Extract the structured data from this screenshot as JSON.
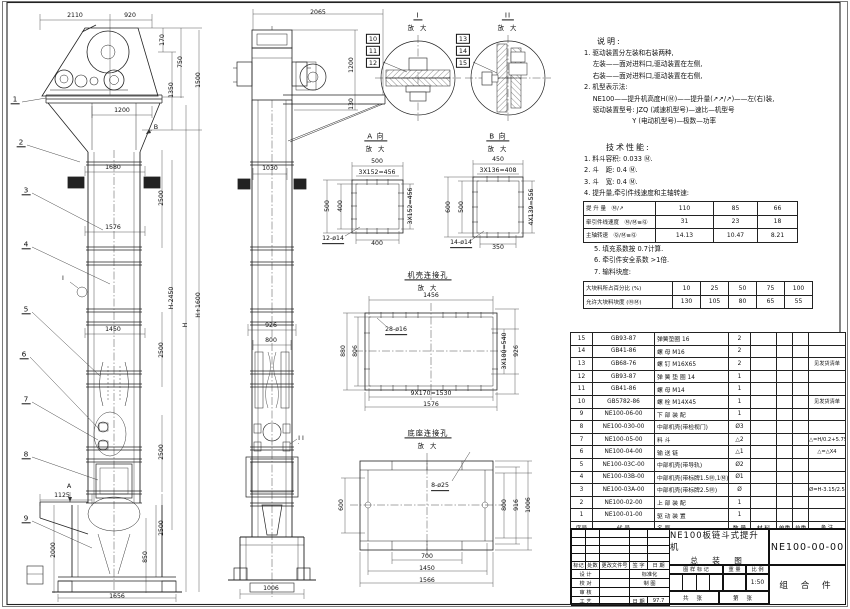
{
  "views": {
    "front": {
      "dims": [
        "2110",
        "920",
        "170",
        "750",
        "1350",
        "1500",
        "1200",
        "1680",
        "2500",
        "1576",
        "H+1600",
        "H-2450",
        "H",
        "1450",
        "2500",
        "2500",
        "2500",
        "1125",
        "2000",
        "850",
        "1656"
      ],
      "leaders": [
        "1",
        "2",
        "3",
        "4",
        "5",
        "6",
        "7",
        "8",
        "9"
      ],
      "section_a": "A",
      "section_b": "B",
      "detail_ref": "I"
    },
    "side": {
      "dims": [
        "2065",
        "1200",
        "130",
        "1030",
        "926",
        "800",
        "1006"
      ],
      "stack_i": [
        "10",
        "11",
        "12"
      ],
      "stack_ii": [
        "13",
        "14",
        "15"
      ],
      "detail_ref": "II"
    },
    "detail_i": {
      "title": "I",
      "zoom": "放 大"
    },
    "detail_ii": {
      "title": "II",
      "zoom": "放 大"
    },
    "view_a": {
      "title": "A 向",
      "zoom": "放 大",
      "dims": [
        "500",
        "3X152=456",
        "500",
        "400",
        "3X152=456",
        "400"
      ],
      "holes": "12-ø14"
    },
    "view_b": {
      "title": "B 向",
      "zoom": "放 大",
      "dims": [
        "450",
        "3X136=408",
        "600",
        "500",
        "4X139=556",
        "350"
      ],
      "holes": "14-ø14"
    },
    "casing": {
      "title": "机壳连接孔",
      "zoom": "放 大",
      "dims": [
        "1456",
        "880",
        "806",
        "3X180=540",
        "926",
        "9X170=1530",
        "1576"
      ],
      "holes": "28-ø16"
    },
    "base": {
      "title": "底座连接孔",
      "zoom": "放 大",
      "dims": [
        "600",
        "800",
        "916",
        "1006",
        "700",
        "1450",
        "1566"
      ],
      "holes": "8-ø25"
    }
  },
  "notes": {
    "title": "说明:",
    "lines": [
      "1. 驱动装置分左装和右装两种,",
      "　 左装——面对进料口,驱动装置在左侧,",
      "　 右装——面对进料口,驱动装置在右侧,",
      "2. 机型表示法:",
      "　 NE100——提升机高度H(Ⓜ)——提升量(↗↗/↗)——左(右)装,",
      "　 驱动装置型号: JZQ (减速机型号)—速比—机型号",
      "　　　　　　　 Y (电动机型号)—极数—功率"
    ]
  },
  "tech": {
    "title": "技术性能:",
    "lines": [
      "1. 料斗容积: 0.033 Ⓜ.",
      "2. 斗　距: 0.4 Ⓜ.",
      "3. 斗　宽: 0.4 Ⓜ.",
      "4. 提升量,牵引件线速度和主轴转速:"
    ],
    "lines2": [
      "5. 填充系数按 0.7计算.",
      "6. 牵引件安全系数 >1倍.",
      "7. 输料块度:"
    ]
  },
  "speed_table": {
    "rows": [
      {
        "label": "提 升 量　Ⓜ/↗",
        "v1": "110",
        "v2": "85",
        "v3": "66"
      },
      {
        "label": "牵引件线速度　Ⓜ/Ⓜ≡Ⓠ",
        "v1": "31",
        "v2": "23",
        "v3": "18"
      },
      {
        "label": "主轴转速　Ⓠ/Ⓜ≡Ⓠ",
        "v1": "14.13",
        "v2": "10.47",
        "v3": "8.21"
      }
    ]
  },
  "lump_table": {
    "rows": [
      {
        "label": "大块料所占百分比 (%)",
        "v1": "10",
        "v2": "25",
        "v3": "50",
        "v4": "75",
        "v5": "100"
      },
      {
        "label": "允许大块料块度 (ⓂⓂ)",
        "v1": "130",
        "v2": "105",
        "v3": "80",
        "v4": "65",
        "v5": "55"
      }
    ]
  },
  "parts_list": {
    "headers": [
      "序号",
      "代  号",
      "名  称",
      "数 量",
      "材  料",
      "单重",
      "总重",
      "备 注"
    ],
    "rows": [
      {
        "no": "15",
        "code": "GB93-87",
        "name": "弹簧垫圈 16",
        "qty": "2",
        "mat": "",
        "uw": "",
        "tw": "",
        "rem": ""
      },
      {
        "no": "14",
        "code": "GB41-86",
        "name": "螺  母 M16",
        "qty": "2",
        "mat": "",
        "uw": "",
        "tw": "",
        "rem": ""
      },
      {
        "no": "13",
        "code": "GB68-76",
        "name": "螺  钉 M16X65",
        "qty": "2",
        "mat": "",
        "uw": "",
        "tw": "",
        "rem": "见发货清单"
      },
      {
        "no": "12",
        "code": "GB93-87",
        "name": "弹 簧 垫 圈 14",
        "qty": "1",
        "mat": "",
        "uw": "",
        "tw": "",
        "rem": ""
      },
      {
        "no": "11",
        "code": "GB41-86",
        "name": "螺  母 M14",
        "qty": "1",
        "mat": "",
        "uw": "",
        "tw": "",
        "rem": ""
      },
      {
        "no": "10",
        "code": "GB5782-86",
        "name": "螺  栓 M14X45",
        "qty": "1",
        "mat": "",
        "uw": "",
        "tw": "",
        "rem": "见发货清单"
      },
      {
        "no": "9",
        "code": "NE100-06-00",
        "name": "下 部 装 配",
        "qty": "1",
        "mat": "",
        "uw": "",
        "tw": "",
        "rem": ""
      },
      {
        "no": "8",
        "code": "NE100-030-00",
        "name": "中部机壳(带检视门)",
        "qty": "Ø3",
        "mat": "",
        "uw": "",
        "tw": "",
        "rem": ""
      },
      {
        "no": "7",
        "code": "NE100-05-00",
        "name": "料  斗",
        "qty": "△2",
        "mat": "",
        "uw": "",
        "tw": "",
        "rem": "△=H/0.2+5.75"
      },
      {
        "no": "6",
        "code": "NE100-04-00",
        "name": "输 送 链",
        "qty": "△1",
        "mat": "",
        "uw": "",
        "tw": "",
        "rem": "△=△X4"
      },
      {
        "no": "5",
        "code": "NE100-03C-00",
        "name": "中部机壳(带导轨)",
        "qty": "Ø2",
        "mat": "",
        "uw": "",
        "tw": "",
        "rem": ""
      },
      {
        "no": "4",
        "code": "NE100-03B-00",
        "name": "中部机壳(带标牌1.5Ⓜ,1Ⓜ)",
        "qty": "Ø1",
        "mat": "",
        "uw": "",
        "tw": "",
        "rem": ""
      },
      {
        "no": "3",
        "code": "NE100-03A-00",
        "name": "中部机壳(带标牌2.5Ⓜ)",
        "qty": "Ø",
        "mat": "",
        "uw": "",
        "tw": "",
        "rem": "Ø=H-3.15/2.5"
      },
      {
        "no": "2",
        "code": "NE100-02-00",
        "name": "上 部 装 配",
        "qty": "1",
        "mat": "",
        "uw": "",
        "tw": "",
        "rem": ""
      },
      {
        "no": "1",
        "code": "NE100-01-00",
        "name": "驱 动 装 置",
        "qty": "1",
        "mat": "",
        "uw": "",
        "tw": "",
        "rem": ""
      }
    ]
  },
  "title_block": {
    "product": "NE100板链斗式提升机",
    "sheet_name": "总 装 图",
    "drawing_no": "NE100-00-00",
    "part_type": "组 合 件",
    "rev_headers": [
      "标记",
      "处数",
      "更改文件号",
      "签 字",
      "日 期"
    ],
    "roles": [
      {
        "l": "设 计",
        "r": "标准化",
        "v": ""
      },
      {
        "l": "校 对",
        "r": "制 图",
        "v": ""
      },
      {
        "l": "审 核",
        "r": "",
        "v": ""
      },
      {
        "l": "工 艺",
        "r": "日 期",
        "v": "97.7"
      }
    ],
    "stamp_headers": [
      "图 样 标 记",
      "重 量",
      "比 例"
    ],
    "scale": "1:50",
    "sheets": [
      "共  张",
      "第  张"
    ]
  }
}
